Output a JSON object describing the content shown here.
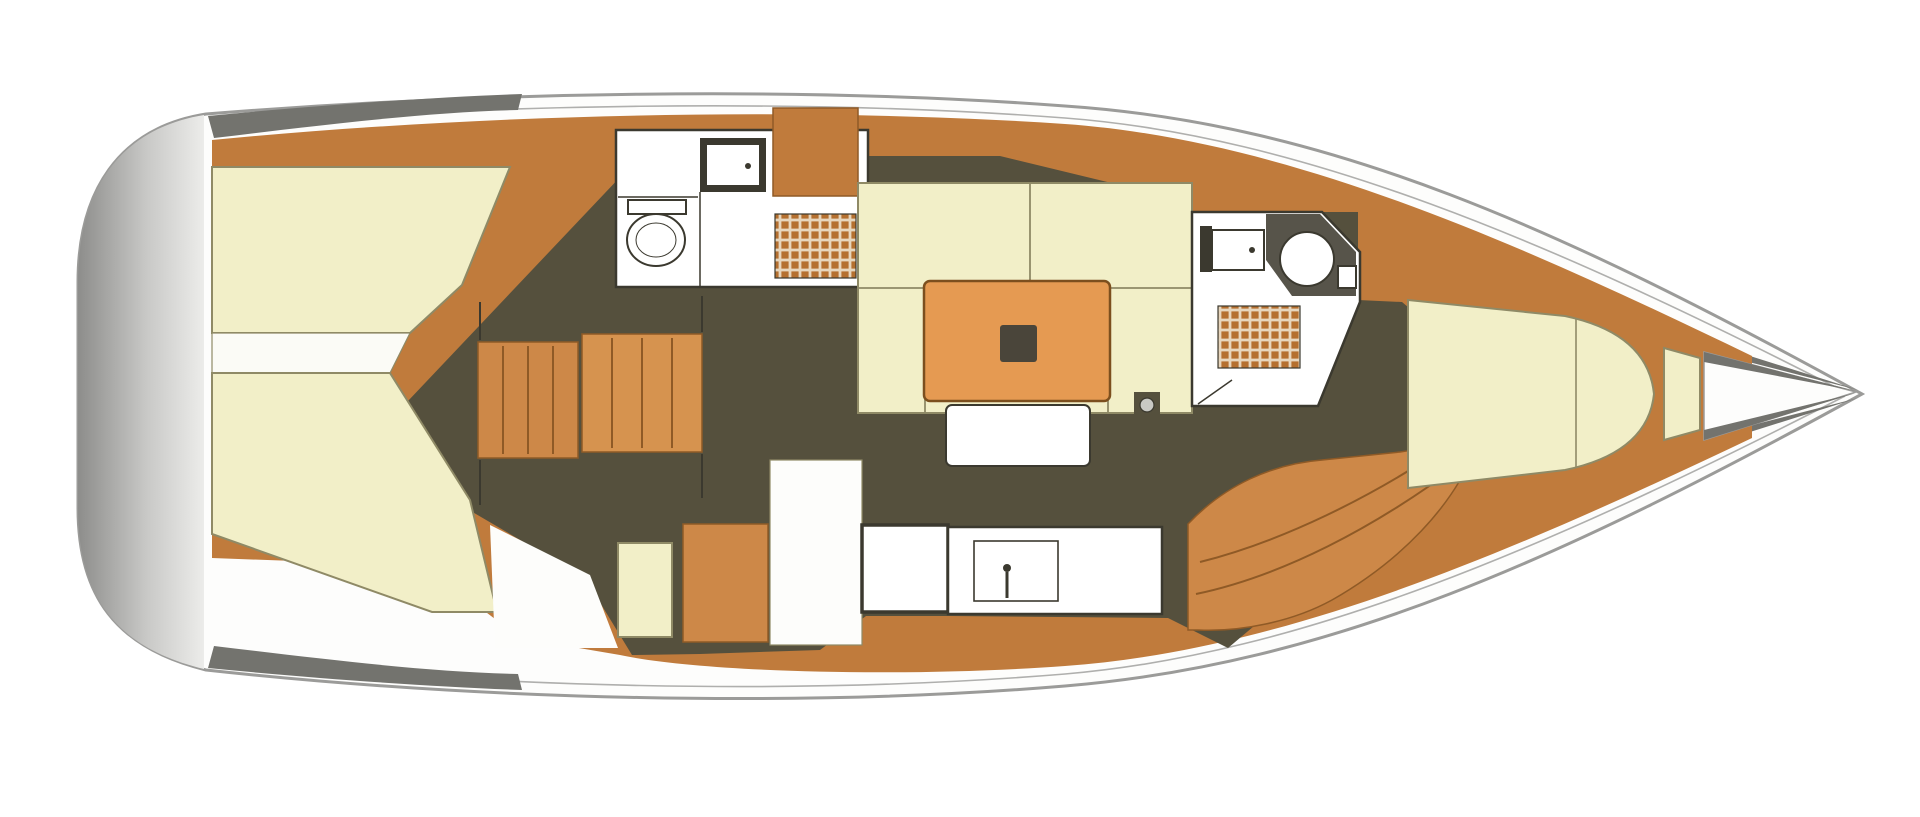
{
  "figure": {
    "type": "yacht-interior-floor-plan",
    "view": "top-down",
    "orientation": "bow-right",
    "text_labels": []
  },
  "palette": {
    "background": "#ffffff",
    "hull_fill": "#fdfdfc",
    "hull_outline": "#9b9b99",
    "transom_dark": "#8d8d8b",
    "transom_mid": "#c9c9c7",
    "transom_light": "#ececea",
    "shadow_gray": "#73736e",
    "deck_wood": "#c07b3c",
    "deck_wood_line": "#8f5a26",
    "step_wood": "#cd8848",
    "step_wood_light": "#d6934f",
    "cabin_sole": "#55503d",
    "cushion_cream": "#f2efc8",
    "cushion_line": "#8f8a66",
    "fixture_white": "#ffffff",
    "counter_white": "#fdfdfb",
    "line_dark": "#3b392f",
    "head_dark": "#57544a",
    "table_orange": "#e59a52",
    "table_line": "#7c4f1e",
    "table_inset": "#4a453a",
    "grate_base": "#b5702f",
    "grate_line": "#e7d6bd",
    "metal_gray": "#c9c9c4",
    "engine_strip": "#fbfbf6"
  },
  "elements": [
    "swim-platform",
    "aft-cabin-port-berth",
    "engine-compartment",
    "aft-cabin-starboard-berth",
    "companionway-steps",
    "companionway-landing",
    "aft-head",
    "aft-head-toilet",
    "aft-head-sink",
    "aft-head-shower-grate",
    "aft-head-locker",
    "saloon-settee",
    "saloon-table",
    "saloon-bench",
    "mast-post",
    "galley-counter",
    "galley-sink",
    "galley-fridge",
    "galley-cabinet",
    "nav-door",
    "forward-head",
    "forward-head-toilet",
    "forward-head-sink",
    "forward-head-shower-grate",
    "hull-side-steps",
    "v-berth",
    "bow-shelf",
    "anchor-locker"
  ]
}
